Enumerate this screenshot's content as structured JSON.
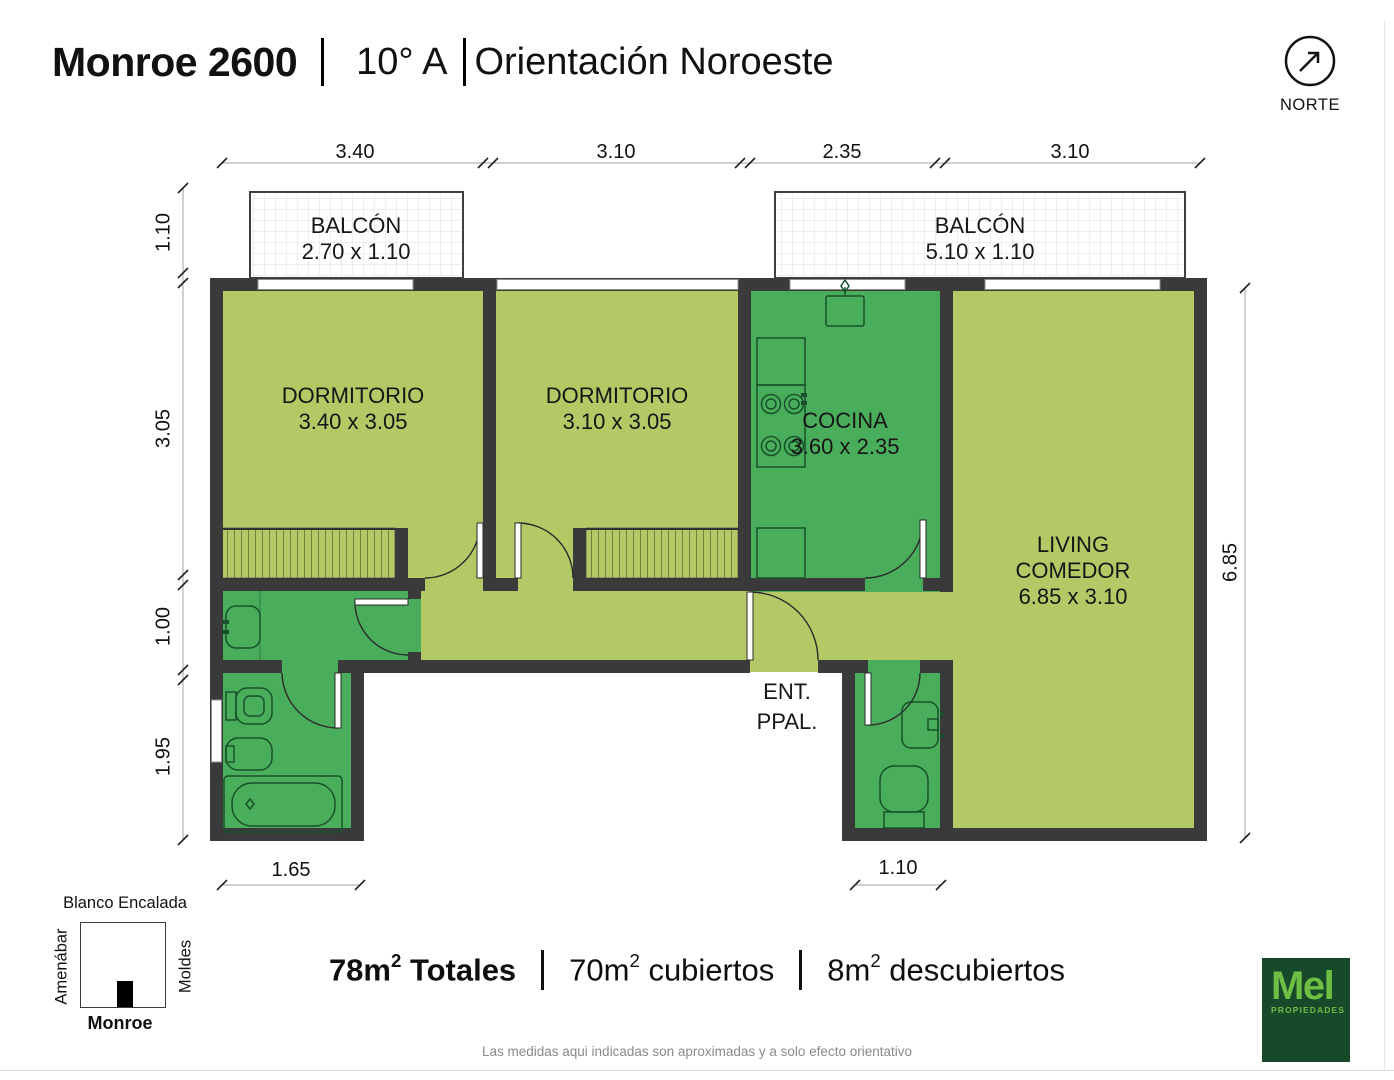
{
  "header": {
    "building": "Monroe 2600",
    "unit": "10° A",
    "orientation": "Orientación Noroeste"
  },
  "north": {
    "label": "NORTE"
  },
  "rooms": {
    "balcon1": {
      "name": "BALCÓN",
      "size": "2.70 x 1.10"
    },
    "balcon2": {
      "name": "BALCÓN",
      "size": "5.10 x 1.10"
    },
    "dorm1": {
      "name": "DORMITORIO",
      "size": "3.40 x 3.05"
    },
    "dorm2": {
      "name": "DORMITORIO",
      "size": "3.10 x 3.05"
    },
    "cocina": {
      "name": "COCINA",
      "size": "3.60 x 2.35"
    },
    "living": {
      "line1": "LIVING",
      "line2": "COMEDOR",
      "size": "6.85 x 3.10"
    },
    "entrance": {
      "line1": "ENT.",
      "line2": "PPAL."
    }
  },
  "dimensions": {
    "top": [
      "3.40",
      "3.10",
      "2.35",
      "3.10"
    ],
    "left": [
      "1.10",
      "3.05",
      "1.00",
      "1.95"
    ],
    "right": [
      "6.85"
    ],
    "bottom_left": "1.65",
    "bottom_right": "1.10"
  },
  "map": {
    "north_street": "Blanco Encalada",
    "west_street": "Amenábar",
    "east_street": "Moldes",
    "south_street": "Monroe"
  },
  "summary": {
    "items": [
      {
        "value": "78m",
        "sup": "2",
        "label": " Totales"
      },
      {
        "value": "70m",
        "sup": "2",
        "label": " cubiertos"
      },
      {
        "value": "8m",
        "sup": "2",
        "label": " descubiertos"
      }
    ]
  },
  "disclaimer": "Las medidas aqui indicadas son aproximadas y a solo efecto orientativo",
  "logo": {
    "brand": "Mel",
    "subtitle": "PROPIEDADES"
  },
  "colors": {
    "room_light": "#b2c966",
    "room_dark": "#4aad5b",
    "wall": "#3a3a3a",
    "logo_bg": "#17492b",
    "logo_green": "#6fbe44"
  }
}
